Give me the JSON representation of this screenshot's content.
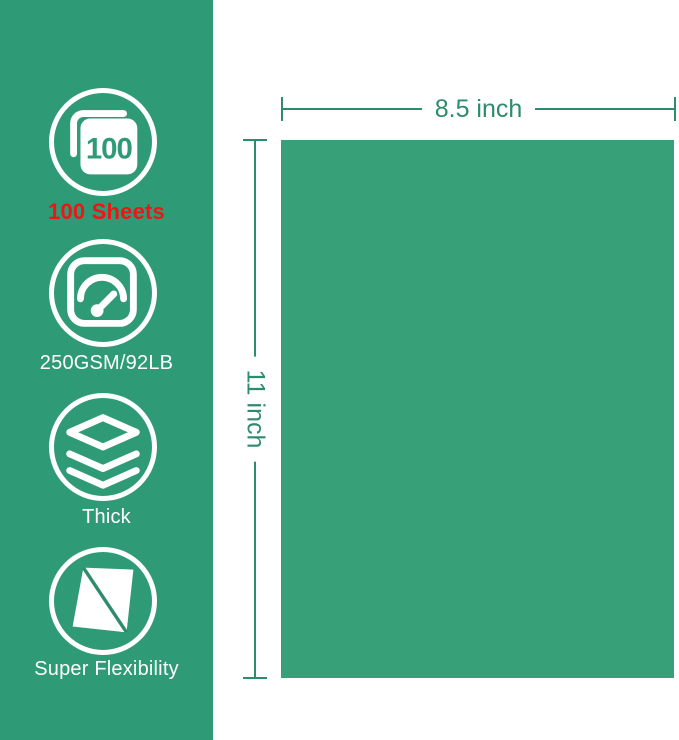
{
  "colors": {
    "sidebar_background": "#2f9b76",
    "paper_fill": "#38a078",
    "dimension_accent": "#2e8b6e",
    "highlight_red": "#ee1515",
    "icon_white": "#ffffff"
  },
  "sidebar": {
    "features": [
      {
        "icon": "sheets-100-icon",
        "badge": "100",
        "label": "100 Sheets"
      },
      {
        "icon": "gauge-icon",
        "label": "250GSM/92LB"
      },
      {
        "icon": "layers-icon",
        "label": "Thick"
      },
      {
        "icon": "flexible-sheet-icon",
        "label": "Super Flexibility"
      }
    ]
  },
  "diagram": {
    "width_label": "8.5 inch",
    "height_label": "11 inch"
  }
}
